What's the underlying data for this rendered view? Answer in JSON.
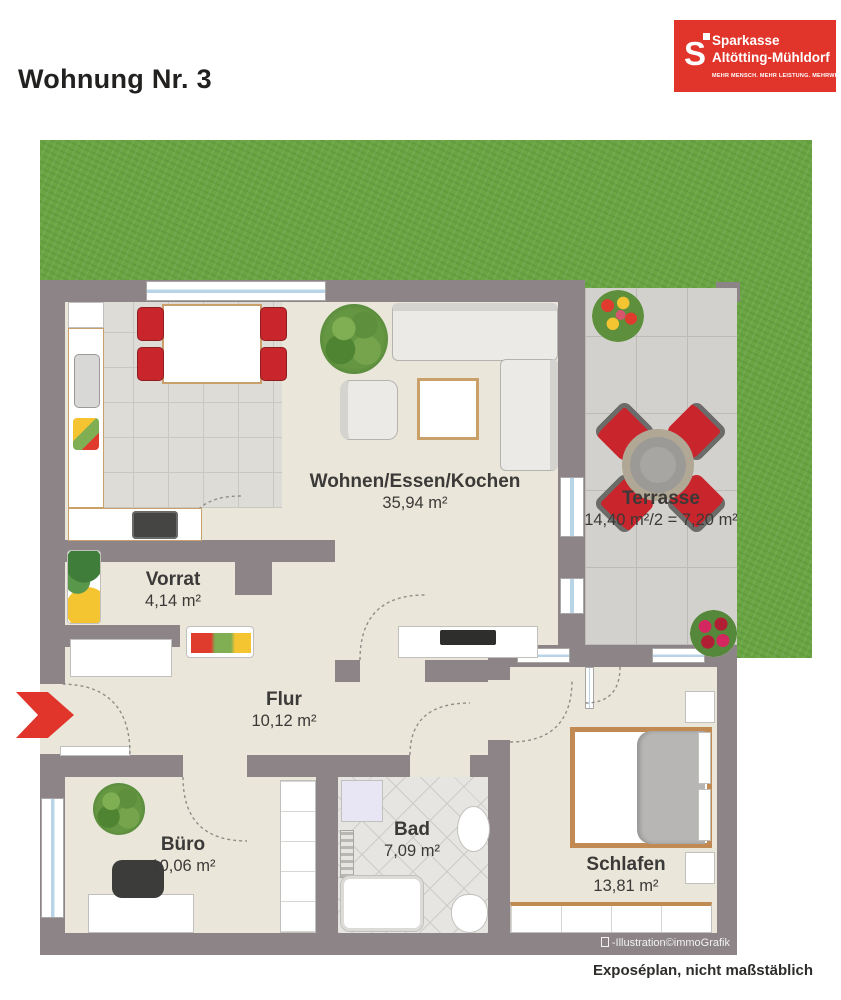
{
  "header": {
    "title": "Wohnung Nr. 3"
  },
  "logo": {
    "mark": "S",
    "line1": "Sparkasse",
    "line2": "Altötting-Mühldorf",
    "tagline": "MEHR MENSCH. MEHR LEISTUNG. MEHRWERT."
  },
  "rooms": [
    {
      "name": "Wohnen/Essen/Kochen",
      "area": "35,94 m²"
    },
    {
      "name": "Terrasse",
      "area": "14,40 m²/2 = 7,20 m²"
    },
    {
      "name": "Vorrat",
      "area": "4,14 m²"
    },
    {
      "name": "Flur",
      "area": "10,12 m²"
    },
    {
      "name": "Büro",
      "area": "10,06 m²"
    },
    {
      "name": "Bad",
      "area": "7,09 m²"
    },
    {
      "name": "Schlafen",
      "area": "13,81 m²"
    }
  ],
  "footer": {
    "credit": "-Illustration©immoGrafik",
    "note": "Exposéplan, nicht maßstäblich"
  },
  "colors": {
    "brand_red": "#e1352b",
    "wall_gray": "#8c8487",
    "grass_green": "#6aa544",
    "floor_beige": "#eae6d9",
    "chair_red": "#c9252c"
  }
}
